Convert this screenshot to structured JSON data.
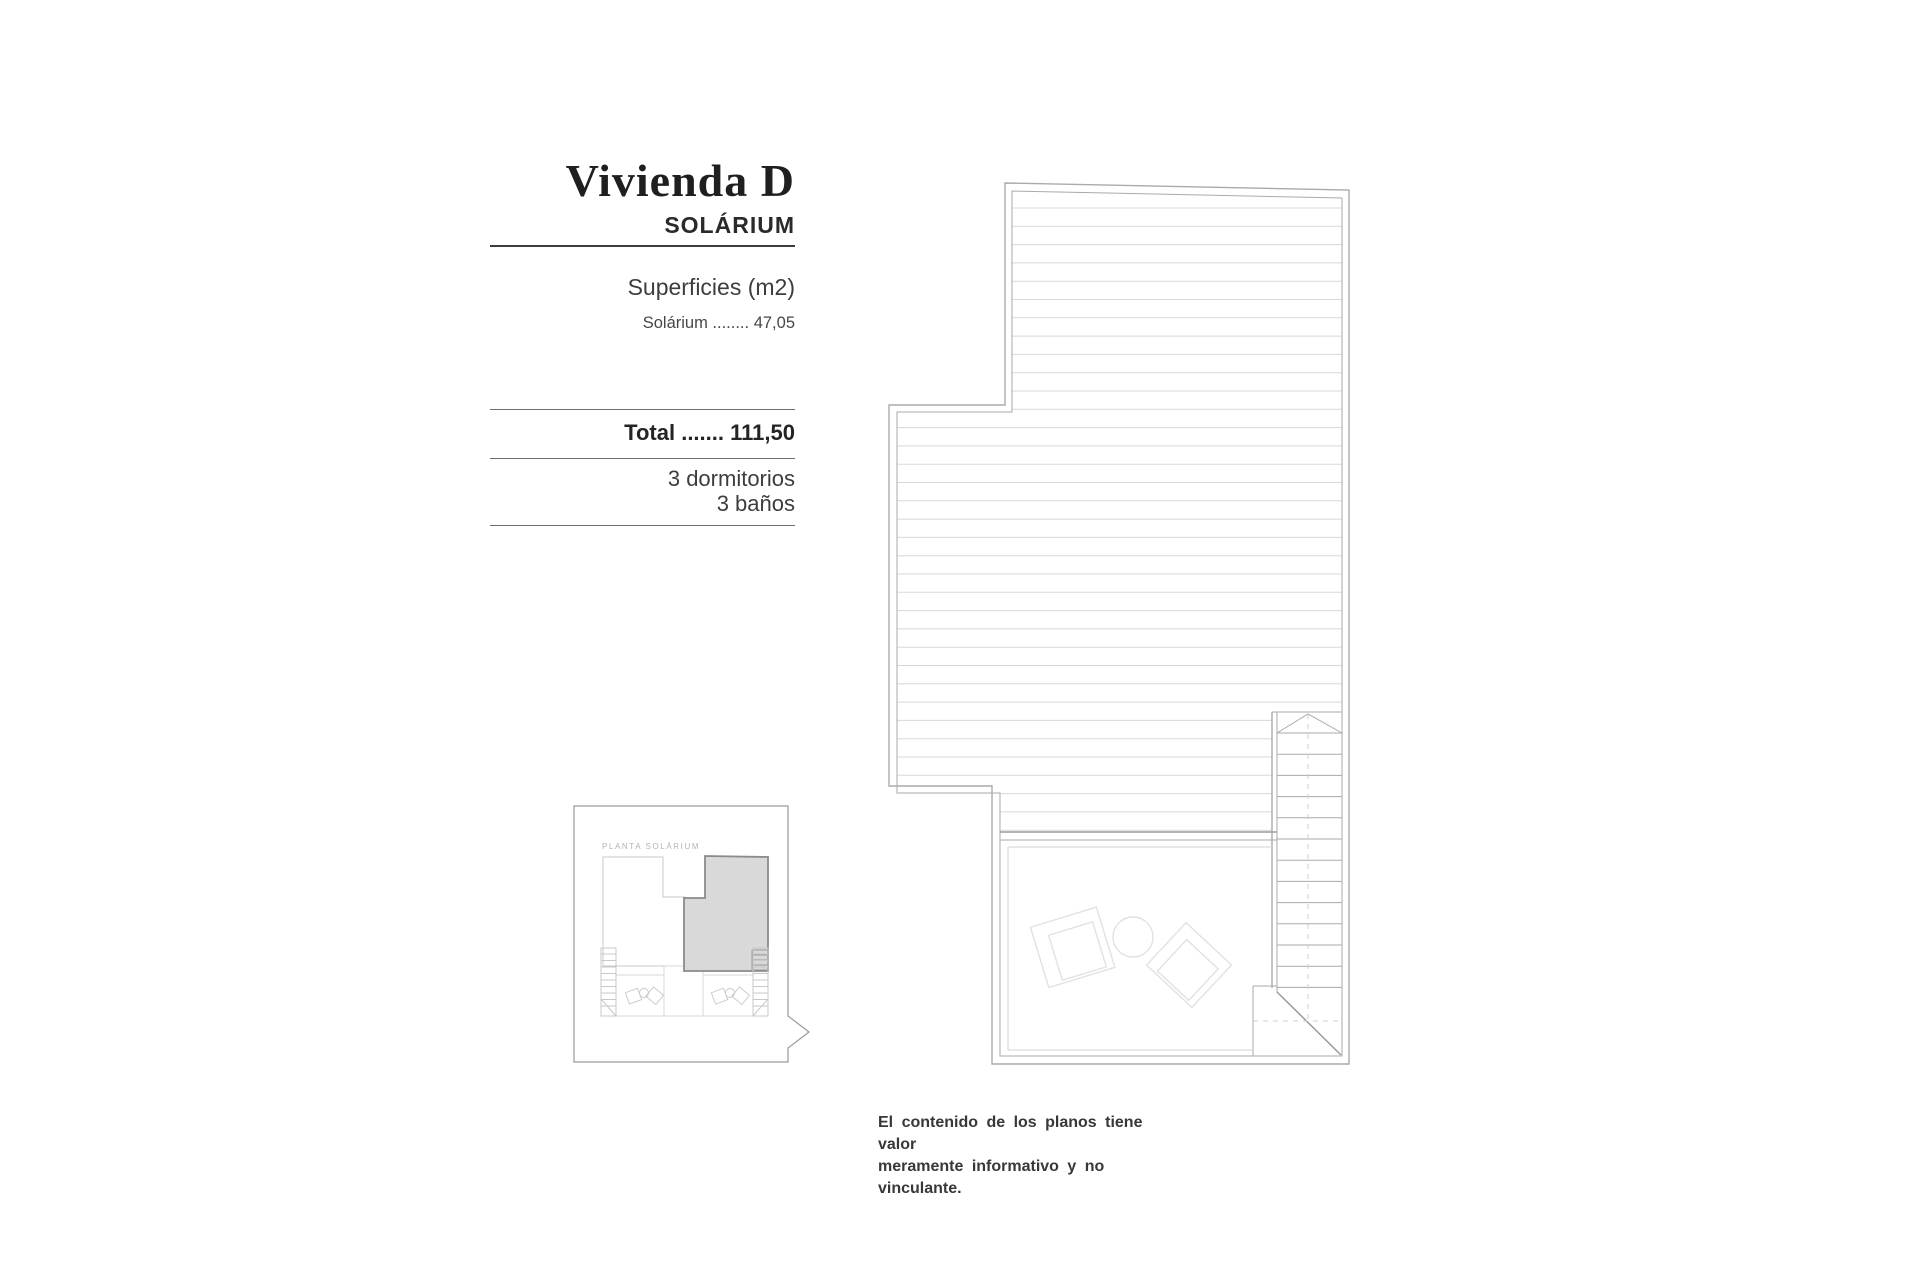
{
  "info_panel": {
    "title": "Vivienda D",
    "subtitle": "SOLÁRIUM",
    "surfaces_heading": "Superficies (m2)",
    "surface_row": {
      "label": "Solárium",
      "dots": "........",
      "value": "47,05"
    },
    "total": {
      "label": "Total",
      "dots": ".......",
      "value": "111,50"
    },
    "features": [
      "3 dormitorios",
      "3 baños"
    ]
  },
  "key_plan": {
    "label": "PLANTA SOLÁRIUM"
  },
  "disclaimer": {
    "line1": "El contenido de los planos tiene valor",
    "line2": "meramente informativo y no vinculante."
  },
  "colors": {
    "wall": "#aaaaaa",
    "wall_dark": "#9a9a9a",
    "hatch": "#d8d8d8",
    "terrace": "#d3d3d3",
    "furniture": "#e2e2e2",
    "dash": "#cfcfcf",
    "key_border": "#9a9a9a",
    "key_line": "#c8c8c8",
    "key_light": "#d7d7d7",
    "highlight_fill": "#d9d9d9",
    "highlight_border": "#8b8b8b",
    "text_dark": "#1f1f1f",
    "text_gray": "#3d3d3d",
    "label_light": "#b4b4b4"
  }
}
